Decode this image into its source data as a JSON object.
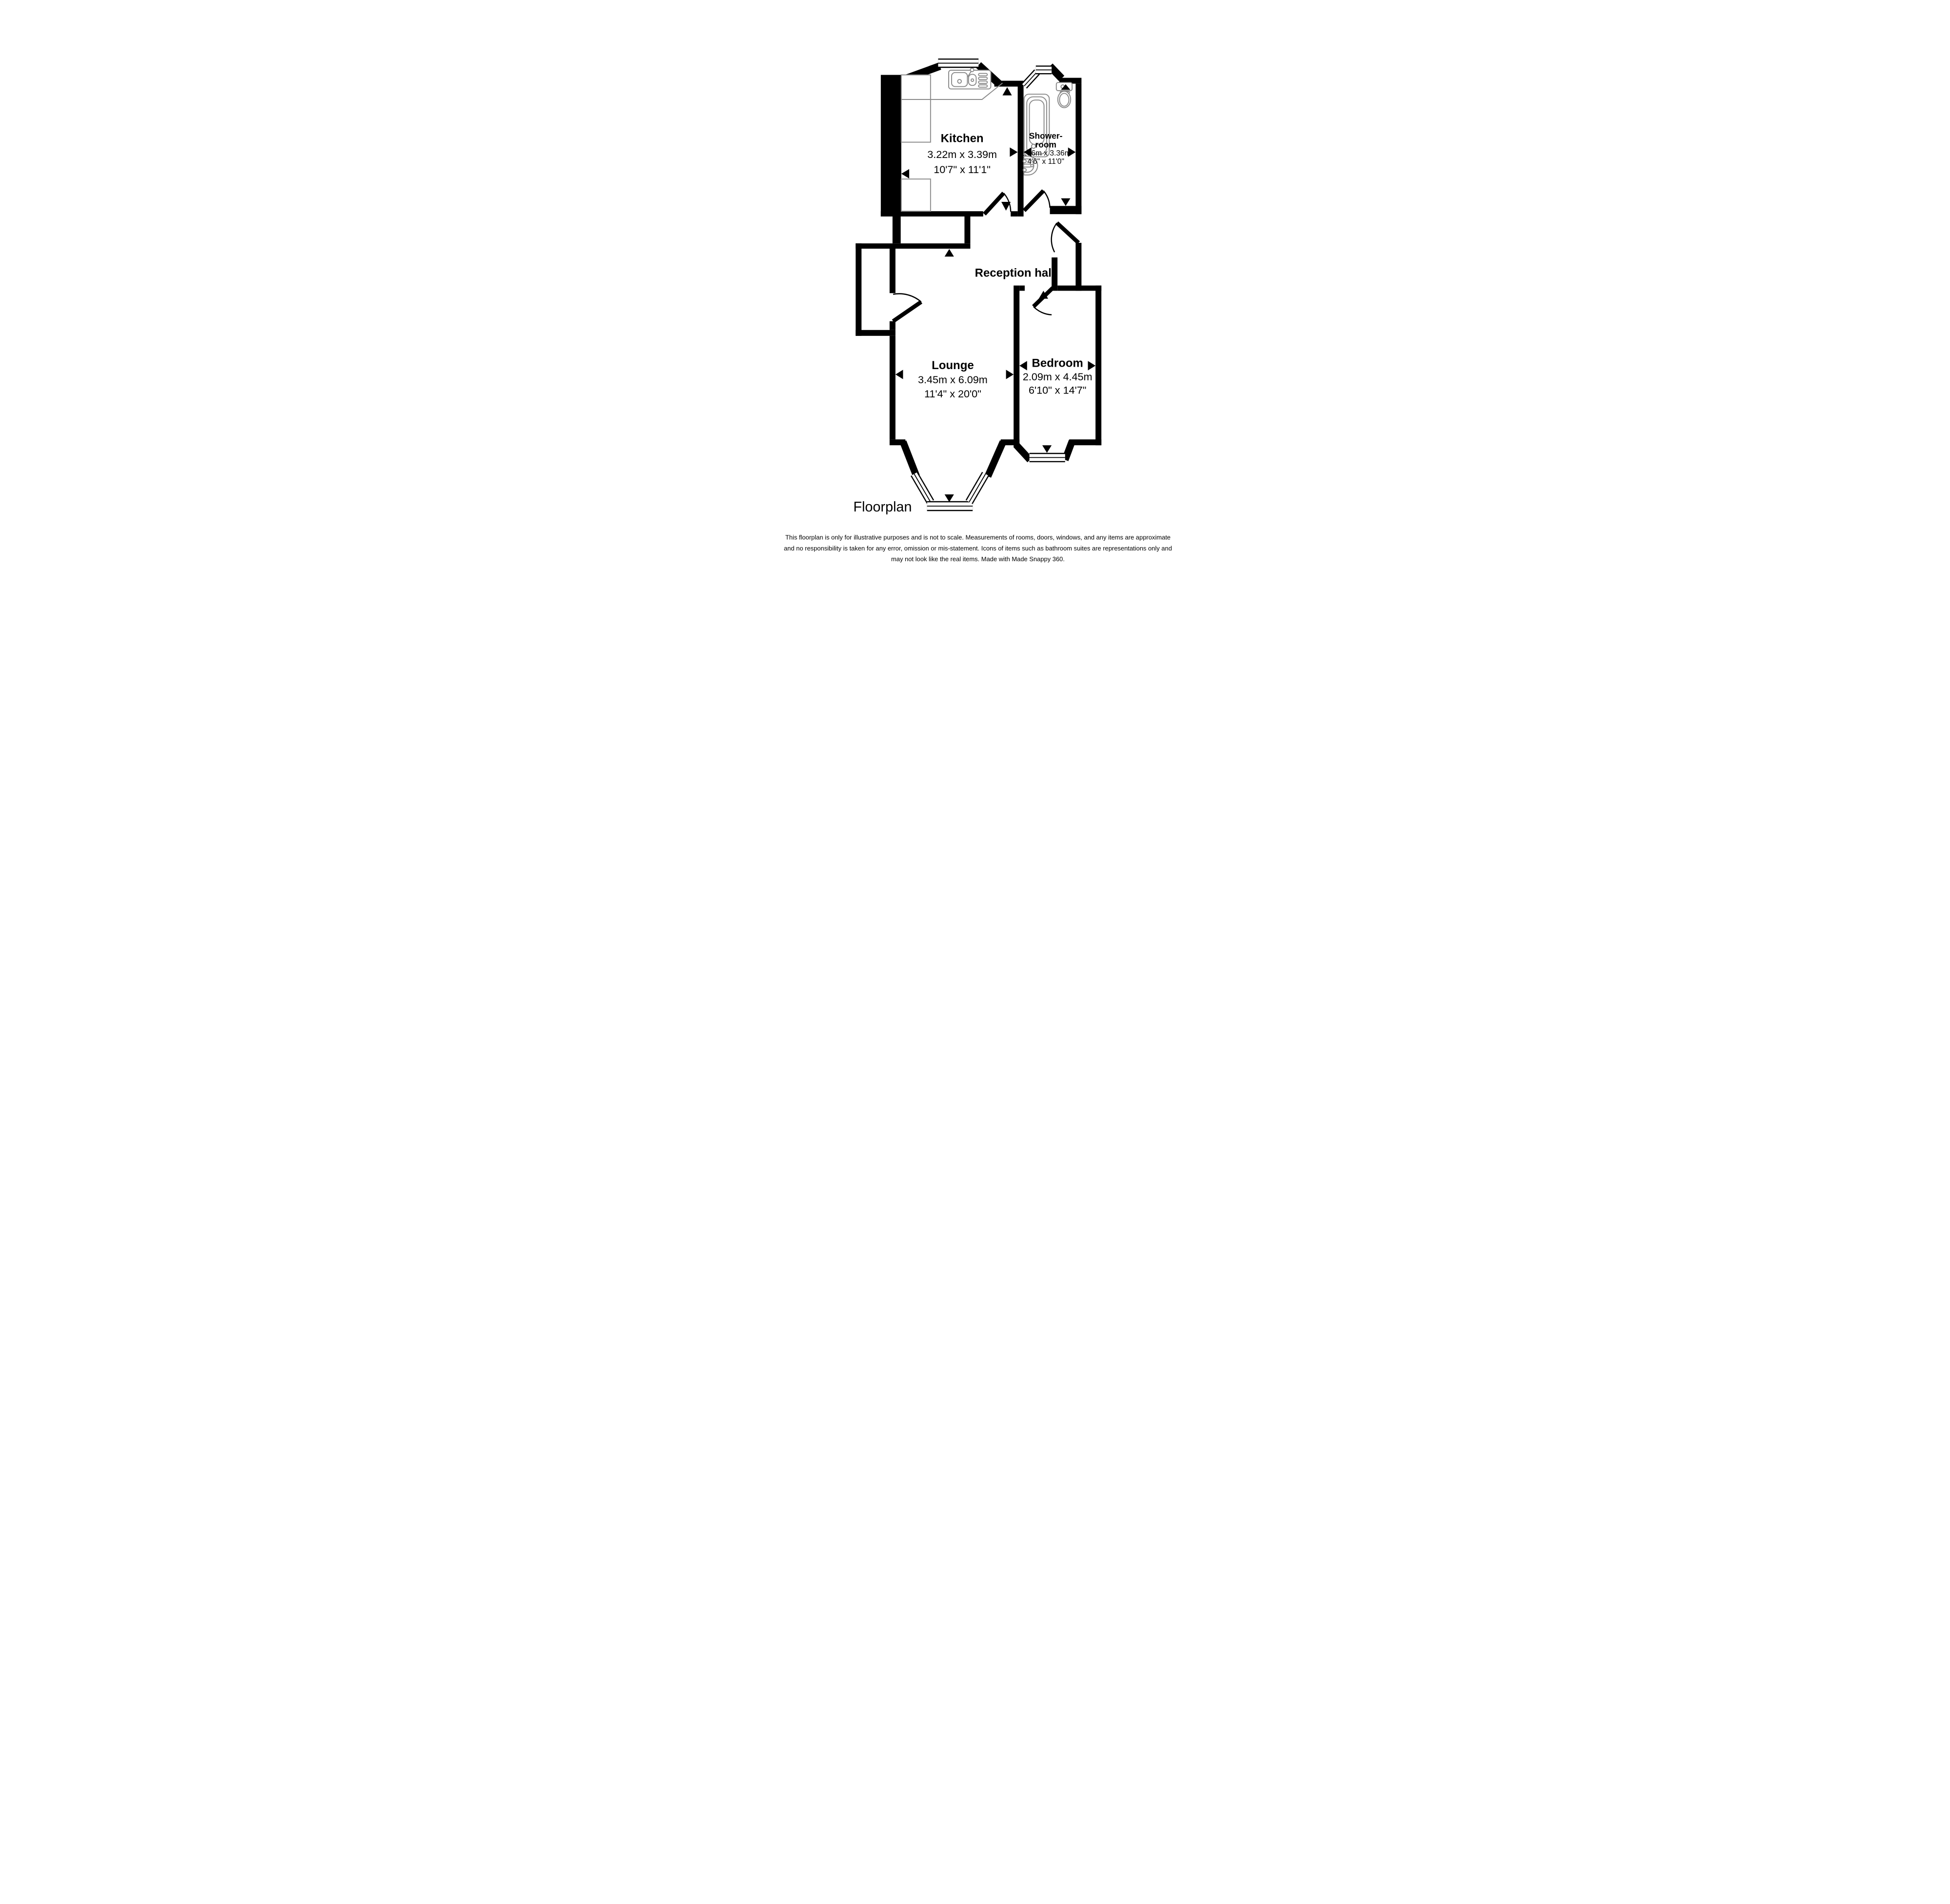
{
  "document": {
    "type_label": "Floorplan",
    "footer_lines": [
      "This floorplan is only for illustrative purposes and is not to scale. Measurements of rooms, doors, windows, and any items are approximate",
      "and no responsibility is taken for any error, omission or mis-statement. Icons of items such as bathroom suites are representations only and",
      "may not look like the real items. Made with Made Snappy 360."
    ]
  },
  "rooms": {
    "kitchen": {
      "name": "Kitchen",
      "metric": "3.22m x 3.39m",
      "imperial": "10'7\" x 11'1\""
    },
    "shower": {
      "name_line1": "Shower-",
      "name_line2": "room",
      "metric": "1.36m x 3.36m",
      "imperial": "4'6\" x 11'0\""
    },
    "reception": {
      "name": "Reception hall"
    },
    "lounge": {
      "name": "Lounge",
      "metric": "3.45m x 6.09m",
      "imperial": "11'4\" x 20'0\""
    },
    "bedroom": {
      "name": "Bedroom",
      "metric": "2.09m x 4.45m",
      "imperial": "6'10\" x 14'7\""
    }
  },
  "colors": {
    "wall": "#000000",
    "fixture_outline": "#8a8a8a",
    "text": "#000000",
    "background": "#ffffff"
  }
}
